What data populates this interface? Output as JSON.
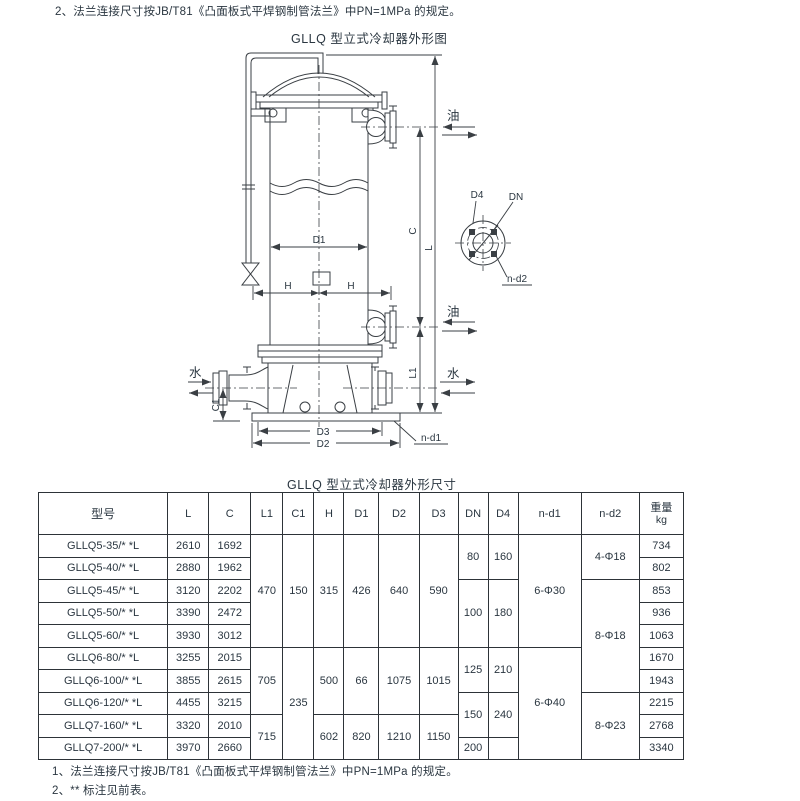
{
  "page": {
    "top_note": "2、法兰连接尺寸按JB/T81《凸面板式平焊钢制管法兰》中PN=1MPa 的规定。",
    "diagram_title": "GLLQ 型立式冷却器外形图",
    "table_title": "GLLQ 型立式冷却器外形尺寸",
    "bottom_note_1": "1、法兰连接尺寸按JB/T81《凸面板式平焊钢制管法兰》中PN=1MPa 的规定。",
    "bottom_note_2": "2、** 标注见前表。"
  },
  "colors": {
    "ink": "#2a3640",
    "line": "#3a3f44",
    "background": "#ffffff"
  },
  "diagram": {
    "labels": {
      "oil": "油",
      "water": "水",
      "D1": "D1",
      "D2": "D2",
      "D3": "D3",
      "D4": "D4",
      "DN": "DN",
      "H": "H",
      "C": "C",
      "L": "L",
      "L1": "L1",
      "C1": "C1",
      "n_d1": "n-d1",
      "n_d2": "n-d2"
    }
  },
  "table": {
    "headers": [
      {
        "label": "型号"
      },
      {
        "label": "L"
      },
      {
        "label": "C"
      },
      {
        "label": "L1"
      },
      {
        "label": "C1"
      },
      {
        "label": "H"
      },
      {
        "label": "D1"
      },
      {
        "label": "D2"
      },
      {
        "label": "D3"
      },
      {
        "label": "DN"
      },
      {
        "label": "D4"
      },
      {
        "label": "n-d1"
      },
      {
        "label": "n-d2"
      },
      {
        "label": "重量",
        "sub": "kg"
      }
    ],
    "rows": [
      [
        {
          "v": "GLLQ5-35/* *L"
        },
        {
          "v": "2610"
        },
        {
          "v": "1692"
        },
        {
          "v": "470",
          "rs": 5
        },
        {
          "v": "150",
          "rs": 5
        },
        {
          "v": "315",
          "rs": 5
        },
        {
          "v": "426",
          "rs": 5
        },
        {
          "v": "640",
          "rs": 5
        },
        {
          "v": "590",
          "rs": 5
        },
        {
          "v": "80",
          "rs": 2
        },
        {
          "v": "160",
          "rs": 2
        },
        {
          "v": "6-Φ30",
          "rs": 5
        },
        {
          "v": "4-Φ18",
          "rs": 2
        },
        {
          "v": "734"
        }
      ],
      [
        {
          "v": "GLLQ5-40/* *L"
        },
        {
          "v": "2880"
        },
        {
          "v": "1962"
        },
        {
          "v": "802"
        }
      ],
      [
        {
          "v": "GLLQ5-45/* *L"
        },
        {
          "v": "3120"
        },
        {
          "v": "2202"
        },
        {
          "v": "100",
          "rs": 3
        },
        {
          "v": "180",
          "rs": 3
        },
        {
          "v": "8-Φ18",
          "rs": 5
        },
        {
          "v": "853"
        }
      ],
      [
        {
          "v": "GLLQ5-50/* *L"
        },
        {
          "v": "3390"
        },
        {
          "v": "2472"
        },
        {
          "v": "936"
        }
      ],
      [
        {
          "v": "GLLQ5-60/* *L"
        },
        {
          "v": "3930"
        },
        {
          "v": "3012"
        },
        {
          "v": "1063"
        }
      ],
      [
        {
          "v": "GLLQ6-80/* *L"
        },
        {
          "v": "3255"
        },
        {
          "v": "2015"
        },
        {
          "v": "705",
          "rs": 3
        },
        {
          "v": "235",
          "rs": 5
        },
        {
          "v": "500",
          "rs": 3
        },
        {
          "v": "66",
          "rs": 3
        },
        {
          "v": "1075",
          "rs": 3
        },
        {
          "v": "1015",
          "rs": 3
        },
        {
          "v": "125",
          "rs": 2
        },
        {
          "v": "210",
          "rs": 2
        },
        {
          "v": "6-Φ40",
          "rs": 5
        },
        {
          "v": "1670"
        }
      ],
      [
        {
          "v": "GLLQ6-100/* *L"
        },
        {
          "v": "3855"
        },
        {
          "v": "2615"
        },
        {
          "v": "1943"
        }
      ],
      [
        {
          "v": "GLLQ6-120/* *L"
        },
        {
          "v": "4455"
        },
        {
          "v": "3215"
        },
        {
          "v": "150",
          "rs": 2
        },
        {
          "v": "240",
          "rs": 2
        },
        {
          "v": "8-Φ23",
          "rs": 3
        },
        {
          "v": "2215"
        }
      ],
      [
        {
          "v": "GLLQ7-160/* *L"
        },
        {
          "v": "3320"
        },
        {
          "v": "2010"
        },
        {
          "v": "715",
          "rs": 2
        },
        {
          "v": "602",
          "rs": 2
        },
        {
          "v": "820",
          "rs": 2
        },
        {
          "v": "1210",
          "rs": 2
        },
        {
          "v": "1150",
          "rs": 2
        },
        {
          "v": "2768"
        }
      ],
      [
        {
          "v": "GLLQ7-200/* *L"
        },
        {
          "v": "3970"
        },
        {
          "v": "2660"
        },
        {
          "v": "200"
        },
        {
          "v": ""
        },
        {
          "v": "3340"
        }
      ]
    ]
  }
}
